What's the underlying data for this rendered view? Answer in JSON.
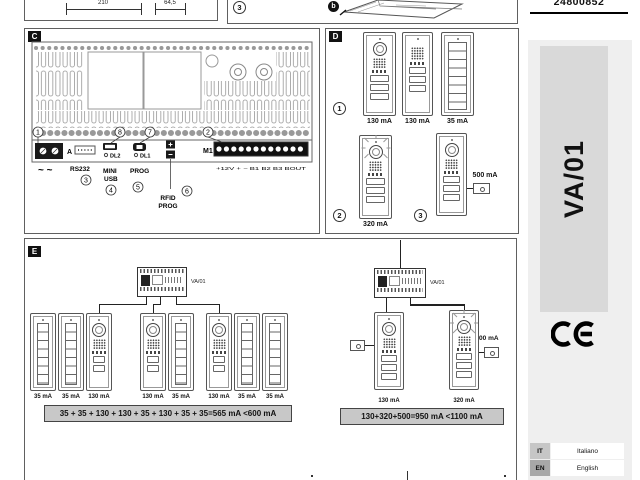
{
  "page": {
    "part_number": "24800852"
  },
  "top_left": {
    "dim_210": "210",
    "dim_64_5": "64,5"
  },
  "top_right": {
    "step": "3",
    "callout_b": "b"
  },
  "section_c": {
    "label": "C",
    "callout_1": "1",
    "callout_2": "2",
    "callout_3": "3",
    "callout_4": "4",
    "callout_5": "5",
    "callout_6": "6",
    "callout_7": "7",
    "callout_8": "8",
    "terminal_a": "A",
    "ac_power": "~ ~",
    "rs232": "RS232",
    "mini": "MINI",
    "usb": "USB",
    "prog": "PROG",
    "dl1": "DL1",
    "dl2": "DL2",
    "m1": "M1",
    "m1_terminals": "+12V  +  −  B1  B2  B3  BOUT",
    "rfid": "RFID",
    "rfid2": "PROG"
  },
  "section_d": {
    "label": "D",
    "callout_1": "1",
    "callout_2": "2",
    "callout_3": "3",
    "row1_currents": [
      "130 mA",
      "130 mA",
      "35 mA"
    ],
    "row2_current": "320 mA",
    "accessory_current": "500 mA"
  },
  "section_e": {
    "label": "E",
    "left": {
      "unit_label": "VA/01",
      "currents": [
        "35 mA",
        "35 mA",
        "130 mA",
        "130 mA",
        "35 mA",
        "130 mA",
        "35 mA",
        "35 mA"
      ],
      "sum": "35 + 35 + 130 + 130 + 35 + 130 + 35 + 35=565 mA <600 mA"
    },
    "right": {
      "unit_label": "VA/01",
      "currents": [
        "130 mA",
        "320 mA"
      ],
      "accessory_current": "500 mA",
      "sum": "130+320+500=950 mA <1100 mA"
    }
  },
  "sidebar": {
    "model": "VA/01",
    "languages": [
      {
        "code": "IT",
        "name": "Italiano"
      },
      {
        "code": "EN",
        "name": "English"
      }
    ]
  }
}
